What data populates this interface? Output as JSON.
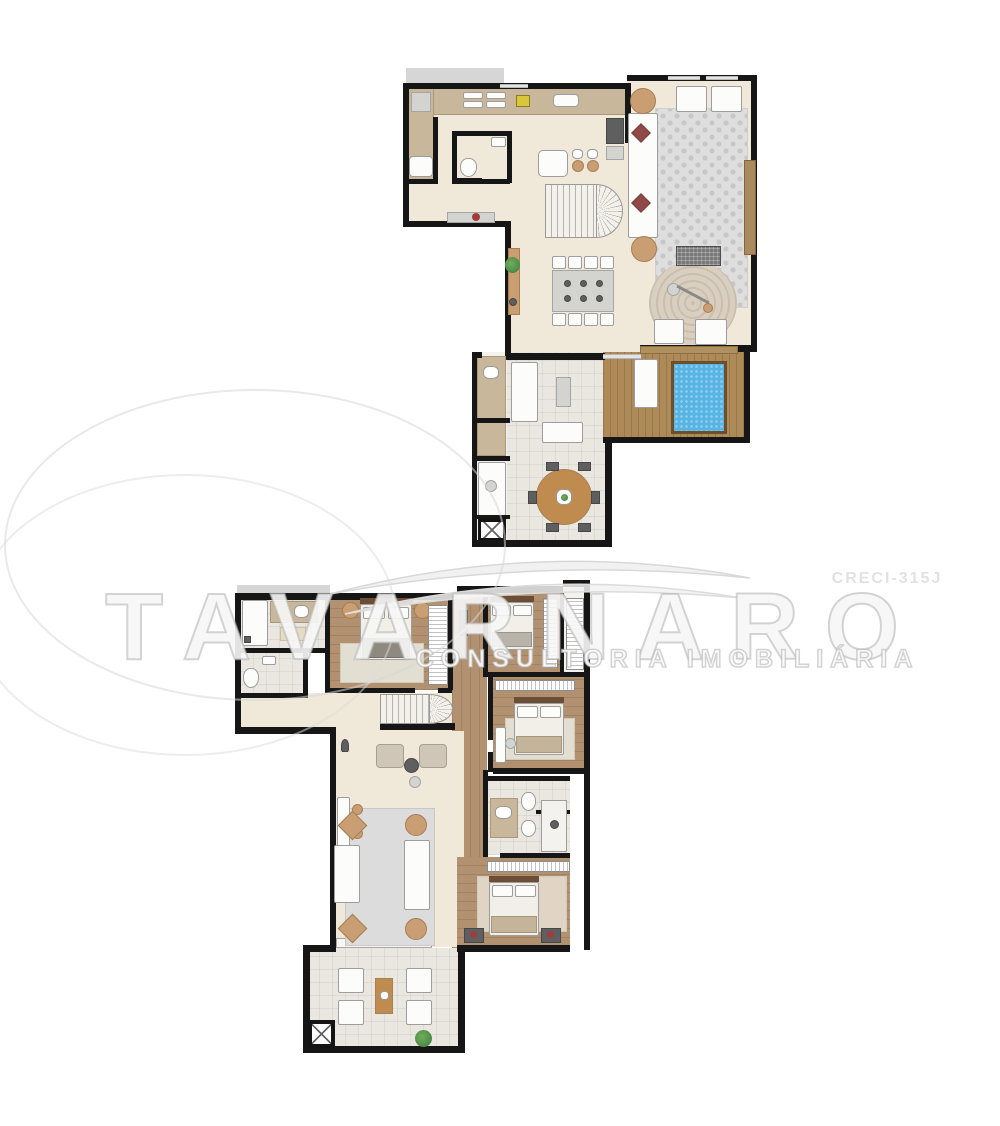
{
  "image_type": "real-estate duplex floor plan (two levels)",
  "watermark": {
    "brand": "TAVARNARO",
    "tagline": "CONSULTORIA IMOBILIÁRIA",
    "license": "CRECI-315J"
  },
  "floors": {
    "upper": {
      "name": "upper-level",
      "areas": [
        "kitchen",
        "service-area",
        "lavatory",
        "living-room",
        "lounge",
        "staircase",
        "dining-area",
        "terrace-room",
        "outdoor-round-dining",
        "pool-deck",
        "support-bath-column"
      ]
    },
    "lower": {
      "name": "lower-level",
      "areas": [
        "bathroom",
        "lavatory",
        "master-bedroom",
        "corridor",
        "bedroom-2",
        "closet",
        "bedroom-3",
        "hall",
        "staircase",
        "sitting-area",
        "living-room",
        "bathroom-2",
        "bedroom-4",
        "terrace"
      ]
    }
  },
  "colors": {
    "wall": "#161616",
    "floor_cream": "#f0e9da",
    "floor_tile": "#e9e7e0",
    "wood_floor": "#b29170",
    "deck_wood": "#ae8a59",
    "pool_water": "#57b4e3",
    "pool_border": "#6d4f2c",
    "rug_gray": "#dedede",
    "furniture_white": "#fcfcfb",
    "accent_tan": "#c89e72",
    "accent_red": "#8f4a48",
    "plant_green": "#4e8f4a",
    "stove_yellow": "#d9c63b",
    "roof_gray": "#d6d6d6",
    "watermark_gray": "#e2e2e2"
  }
}
